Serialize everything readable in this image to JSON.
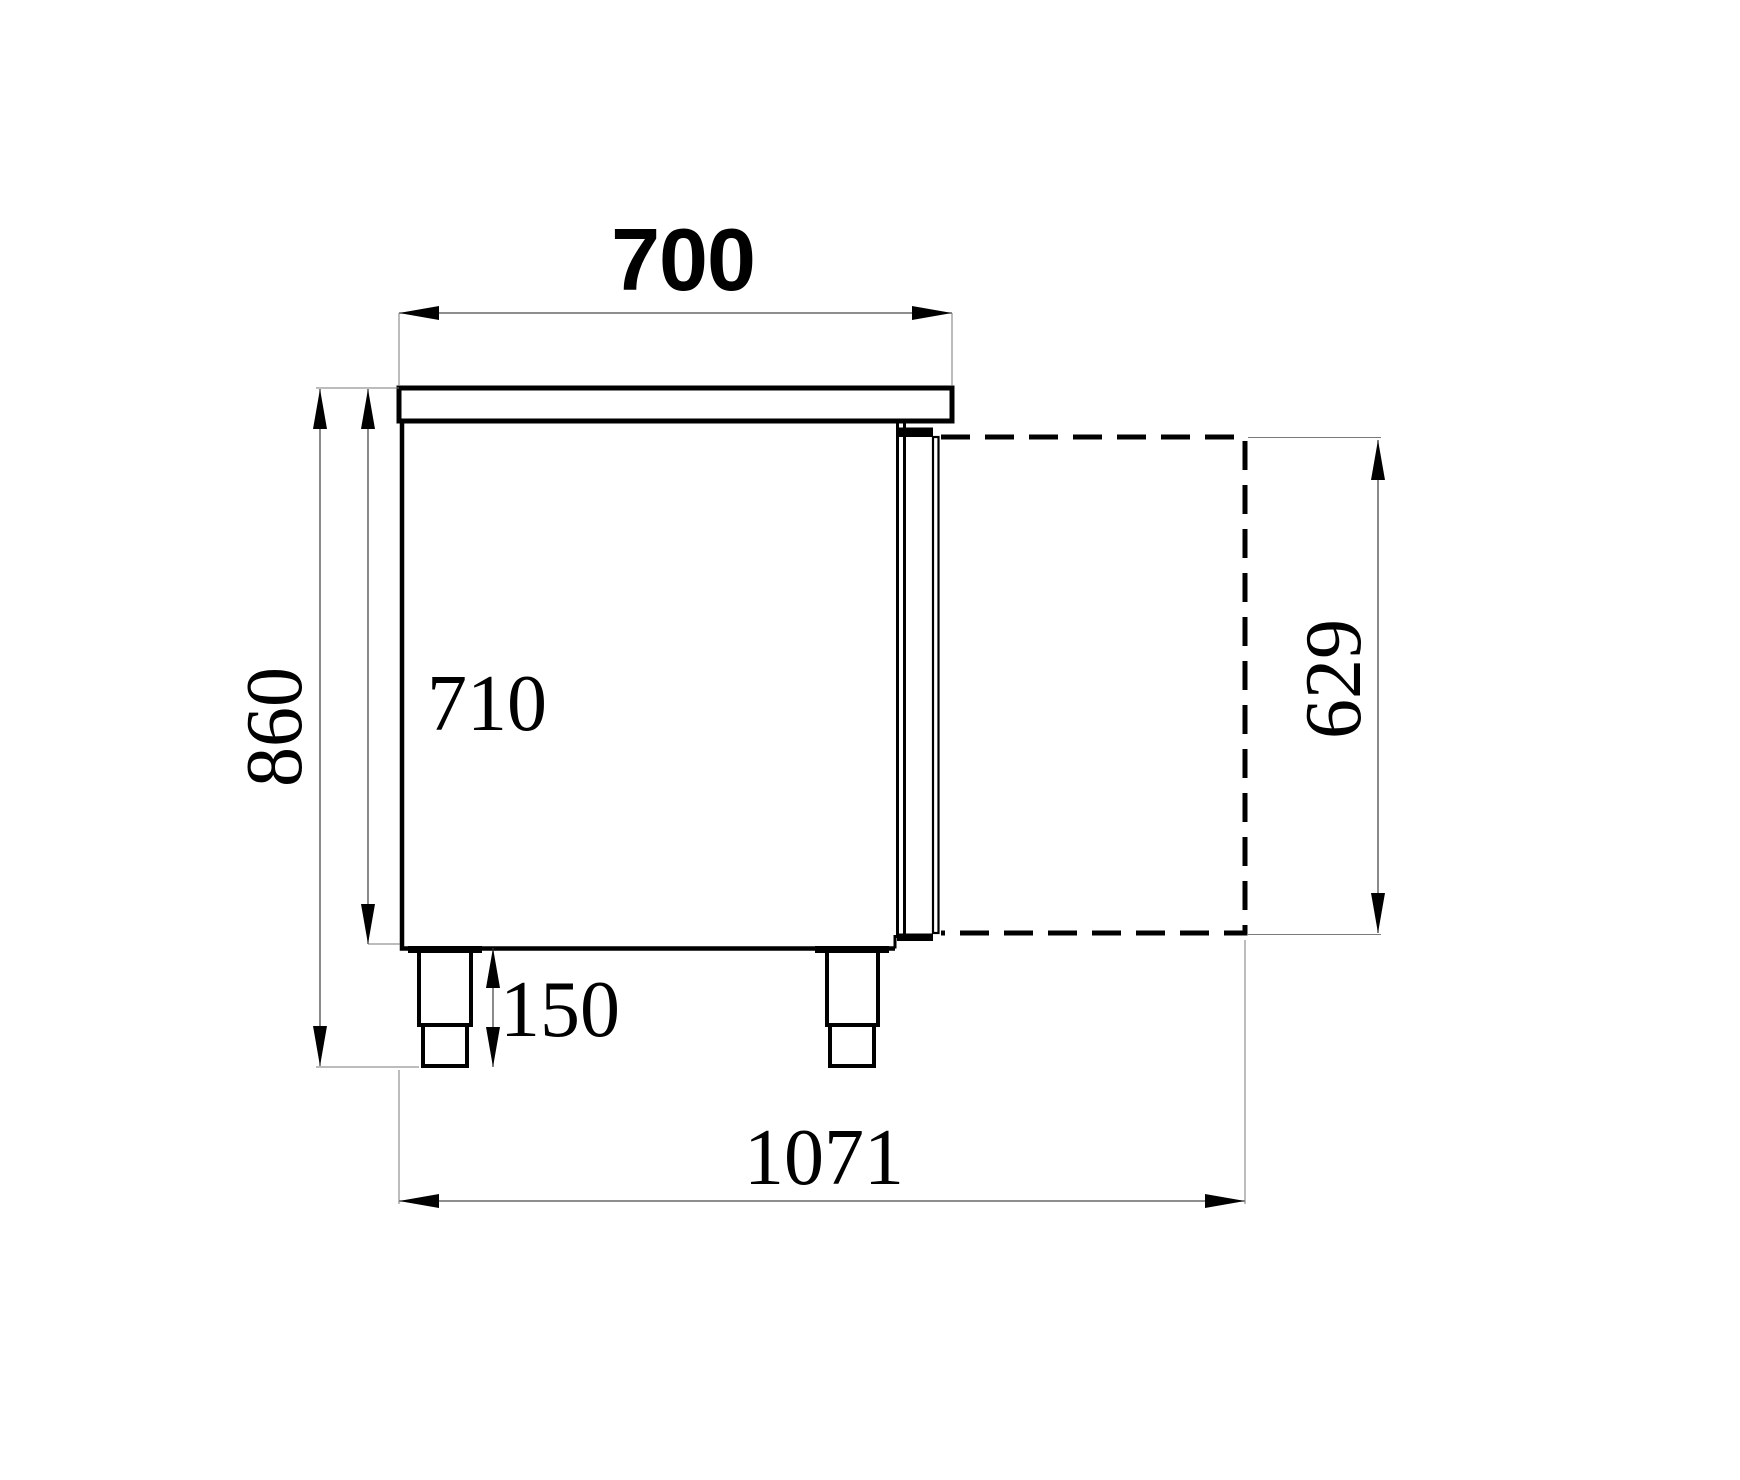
{
  "drawing": {
    "title": "refrigerated counter side-view dimension drawing",
    "colors": {
      "background": "#ffffff",
      "outline": "#000000",
      "dimension_line": "#4a4a4a",
      "extension_line": "#7a7a7a"
    },
    "dimensions": {
      "top_width": "700",
      "overall_height": "860",
      "body_height": "710",
      "leg_height": "150",
      "overall_depth_door_open": "1071",
      "door_height": "629"
    }
  }
}
